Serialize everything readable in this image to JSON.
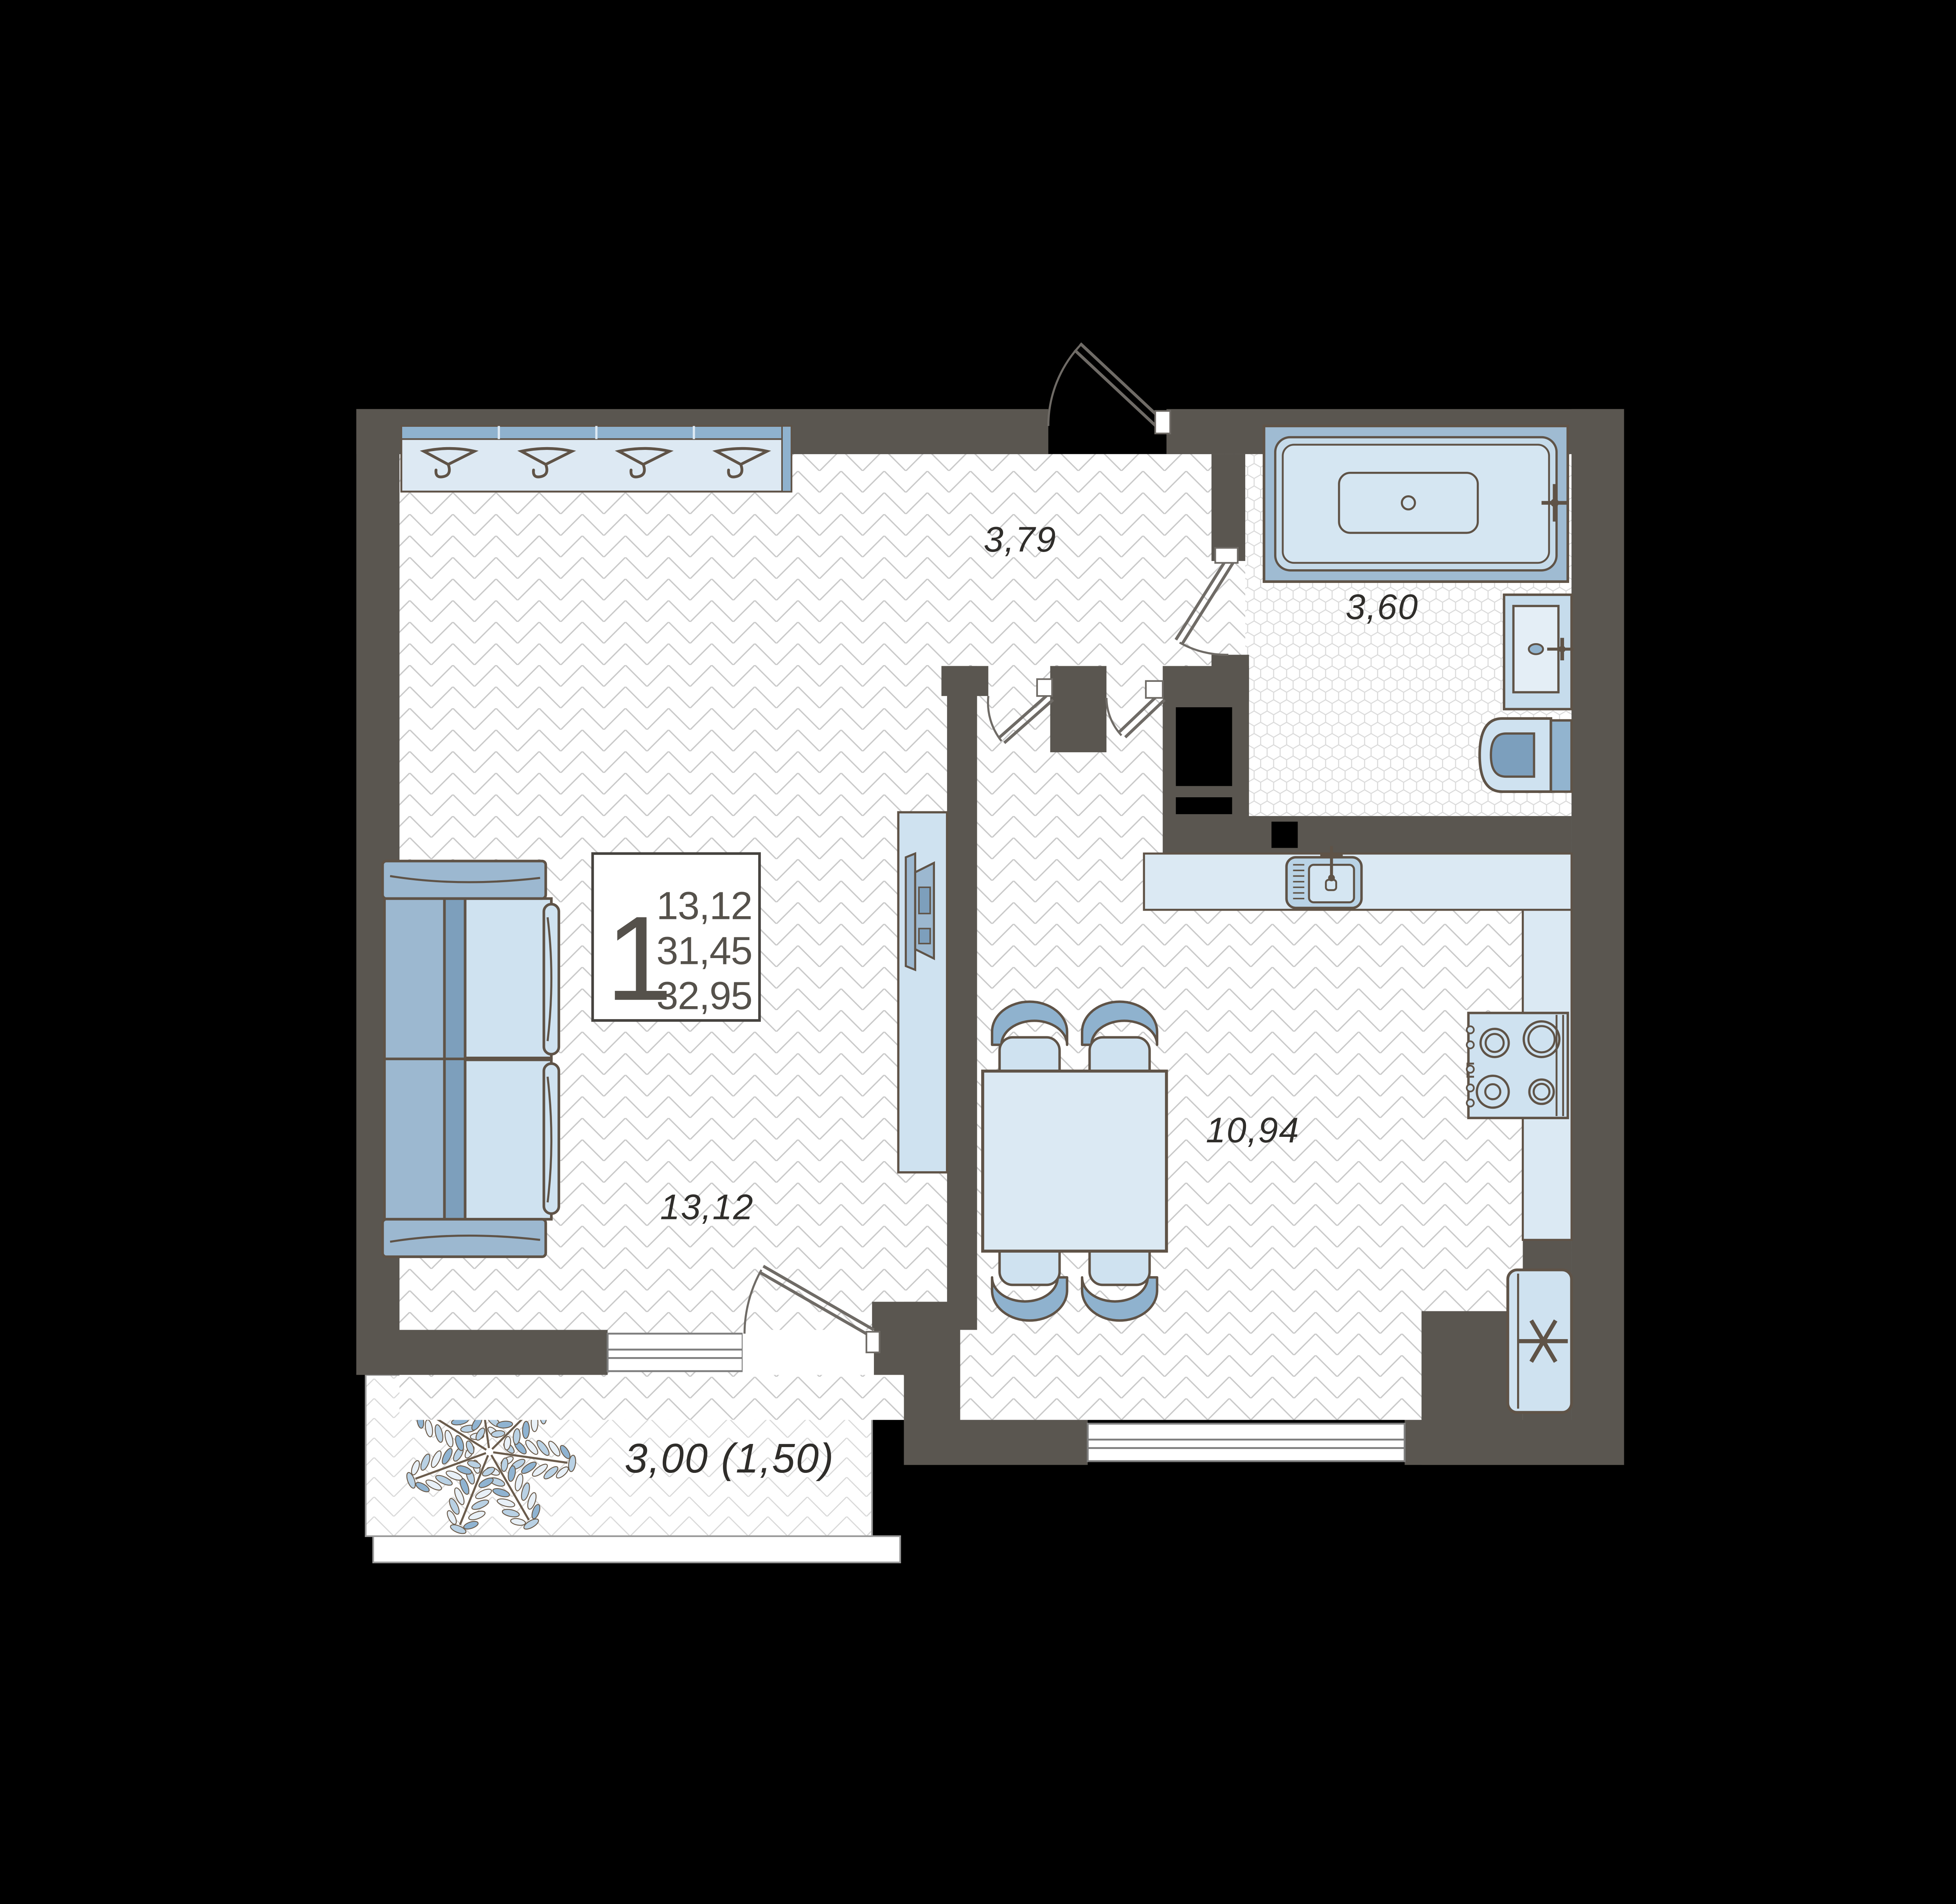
{
  "meta": {
    "kind": "apartment-floor-plan",
    "unit_type": "1-room"
  },
  "unit_card": {
    "rooms_count": "1",
    "living_area": "13,12",
    "apartment_area": "31,45",
    "total_area": "32,95"
  },
  "room_labels": {
    "hallway": "3,79",
    "bathroom": "3,60",
    "kitchen": "10,94",
    "living_room": "13,12",
    "balcony": "3,00 (1,50)"
  },
  "icons": [
    "hanger-icon",
    "bathtub-icon",
    "bath-sink-icon",
    "toilet-icon",
    "kitchen-sink-icon",
    "stove-icon",
    "fridge-snowflake-icon",
    "sofa",
    "tv-icon",
    "dining-table",
    "chair",
    "plant-icon"
  ],
  "colors": {
    "background": "#000000",
    "wall": "#5a5650",
    "outline_brown": "#5f5347",
    "floor_white": "#ffffff",
    "floor_line": "#c9c9c9",
    "hex_tile_line": "#dadada",
    "furniture_light_blue": "#cfe2f0",
    "furniture_mid_blue": "#9cb8d0",
    "furniture_dark_blue": "#7d9fbc",
    "counter_blue": "#dbe9f3",
    "door_line": "#6f6b66",
    "label_text": "#2f2d2a",
    "card_text": "#55514b"
  }
}
